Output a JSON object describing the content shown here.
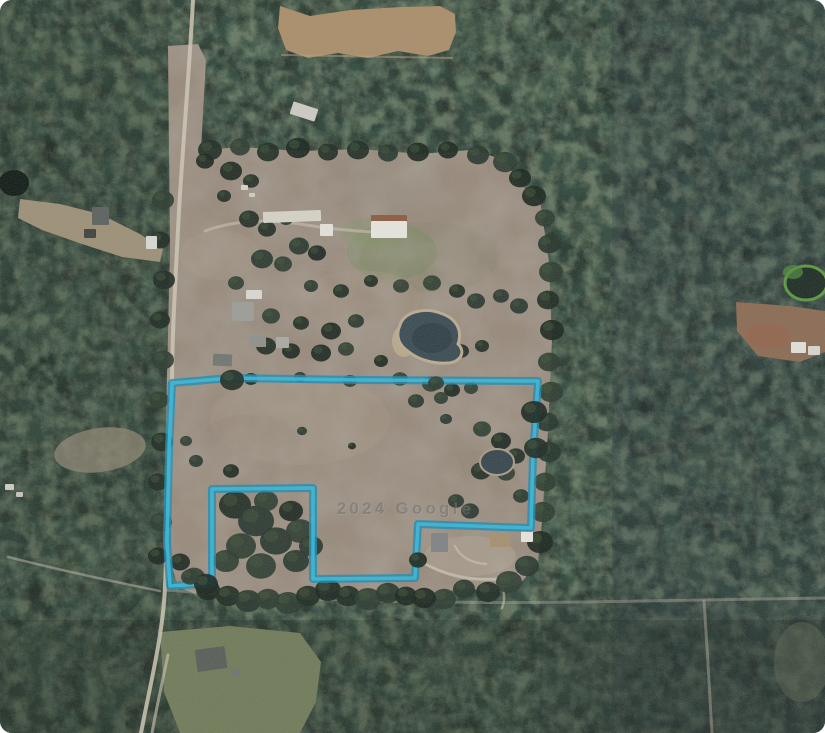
{
  "app": {
    "type": "satellite-imagery-view",
    "alt": "Aerial satellite photo of rural wooded land with pastures, ponds, farm buildings and a cyan property-boundary outline"
  },
  "watermark": {
    "text": "2024 Google"
  },
  "colors": {
    "forest_base": "#26322a",
    "forest_dark": "#16211a",
    "forest_light": "#3f5340",
    "pasture": "#97897b",
    "field": "#a98d69",
    "clearing_tan": "#9c8f76",
    "clearing_green": "#6f7a58",
    "clearing_red": "#8a6a52",
    "road": "#cfc7b4",
    "water_dark": "#2c3b42",
    "water_main": "#394a52",
    "pond_rim": "#bbaa8e",
    "boundary_outer": "#1e89ad",
    "boundary_inner": "#36b7d8",
    "watermark_front": "rgba(70,74,78,0.40)",
    "watermark_back": "rgba(255,255,255,0.16)"
  },
  "boundary": {
    "stroke_width_outer": 8,
    "stroke_width_inner": 3.5,
    "points": [
      [
        172,
        383
      ],
      [
        230,
        378
      ],
      [
        360,
        380
      ],
      [
        538,
        381
      ],
      [
        533,
        455
      ],
      [
        531,
        528
      ],
      [
        418,
        524
      ],
      [
        415,
        578
      ],
      [
        313,
        579
      ],
      [
        313,
        488
      ],
      [
        212,
        489
      ],
      [
        212,
        583
      ],
      [
        170,
        586
      ],
      [
        167,
        540
      ],
      [
        169,
        450
      ]
    ]
  },
  "scene": {
    "pasture_d": "M168,46 L198,44 L206,60 L201,150 L240,147 L300,151 L360,149 L420,154 L470,150 L506,160 L517,182 L540,200 L549,262 L552,340 L548,432 L542,522 L538,562 L520,584 L490,592 L460,587 L430,600 L400,592 L370,598 L340,590 L310,600 L280,594 L250,600 L220,590 L195,594 L178,587 L170,560 L166,420 L170,250 Z",
    "field_d": "M280,6 L310,16 L350,10 L400,7 L440,6 L455,14 L456,32 L449,50 L428,56 L398,51 L368,58 L338,53 L308,58 L286,50 L278,28 Z",
    "left_clearing_d": "M18,218 L42,230 L82,244 L122,257 L160,262 L163,249 L140,234 L100,214 L60,204 L20,199 Z",
    "green_bottom_d": "M160,632 L230,626 L300,633 L321,662 L316,702 L300,733 L180,733 L164,692 Z",
    "right_clearing_d": "M736,302 L790,306 L825,311 L825,352 L800,362 L758,356 L737,331 Z",
    "left_small_ellipse": [
      100,
      450,
      46,
      22,
      "#8f8573",
      0.75,
      -8
    ],
    "red_patch": [
      768,
      336,
      22,
      12,
      "#96604a",
      0.6
    ],
    "br_patch": [
      802,
      662,
      28,
      40,
      "#596350",
      0.5
    ],
    "tint_rects": [
      [
        612,
        0,
        213,
        733,
        "#2a3440",
        0.22
      ],
      [
        540,
        600,
        285,
        133,
        "#222b34",
        0.2
      ],
      [
        0,
        0,
        168,
        733,
        "#202b23",
        0.18
      ],
      [
        0,
        620,
        825,
        113,
        "#1b241d",
        0.25
      ]
    ],
    "pasture_tints": [
      [
        392,
        252,
        45,
        28,
        "#6f8a58",
        0.5
      ],
      [
        368,
        233,
        28,
        16,
        "#7b9160",
        0.45
      ],
      [
        430,
        257,
        70,
        35,
        "#7c8264",
        0.25
      ],
      [
        360,
        300,
        60,
        30,
        "#a1937f",
        0.35
      ],
      [
        300,
        420,
        90,
        45,
        "#a49684",
        0.4
      ],
      [
        470,
        480,
        50,
        30,
        "#8f8374",
        0.35
      ],
      [
        220,
        255,
        40,
        25,
        "#a59780",
        0.3
      ],
      [
        380,
        180,
        70,
        30,
        "#8f8776",
        0.3
      ],
      [
        480,
        205,
        40,
        22,
        "#999079",
        0.3
      ],
      [
        430,
        532,
        60,
        22,
        "#9c8e7e",
        0.35
      ],
      [
        250,
        442,
        50,
        28,
        "#8d8173",
        0.3
      ],
      [
        470,
        556,
        46,
        20,
        "#b3a894",
        0.45
      ],
      [
        200,
        520,
        25,
        40,
        "#9a8c7c",
        0.35
      ]
    ],
    "forest_blobs": [
      [
        50,
        60,
        35,
        1
      ],
      [
        140,
        100,
        28,
        1
      ],
      [
        60,
        330,
        30,
        1
      ],
      [
        30,
        430,
        26,
        1
      ],
      [
        90,
        560,
        30,
        1
      ],
      [
        40,
        650,
        35,
        1
      ],
      [
        120,
        690,
        28,
        1
      ],
      [
        580,
        60,
        30,
        1
      ],
      [
        640,
        140,
        34,
        1
      ],
      [
        700,
        60,
        30,
        1
      ],
      [
        780,
        40,
        32,
        1
      ],
      [
        600,
        220,
        28,
        1
      ],
      [
        660,
        320,
        30,
        1
      ],
      [
        720,
        460,
        34,
        1
      ],
      [
        640,
        480,
        28,
        1
      ],
      [
        580,
        520,
        26,
        1
      ],
      [
        700,
        560,
        30,
        1
      ],
      [
        770,
        600,
        28,
        1
      ],
      [
        620,
        640,
        30,
        1
      ],
      [
        700,
        690,
        32,
        1
      ],
      [
        560,
        680,
        28,
        1
      ],
      [
        360,
        650,
        30,
        1
      ],
      [
        430,
        680,
        28,
        1
      ],
      [
        500,
        700,
        30,
        1
      ],
      [
        250,
        40,
        26,
        1
      ],
      [
        350,
        30,
        24,
        1
      ],
      [
        480,
        30,
        26,
        1
      ],
      [
        540,
        90,
        24,
        1
      ],
      [
        560,
        160,
        26,
        1
      ],
      [
        760,
        200,
        30,
        1
      ],
      [
        800,
        440,
        30,
        1
      ],
      [
        560,
        400,
        26,
        1
      ],
      [
        590,
        470,
        24,
        1
      ],
      [
        30,
        150,
        30,
        0
      ],
      [
        100,
        250,
        28,
        0
      ],
      [
        50,
        380,
        30,
        0
      ],
      [
        20,
        600,
        32,
        0
      ],
      [
        150,
        620,
        26,
        0
      ],
      [
        610,
        90,
        30,
        0
      ],
      [
        690,
        180,
        34,
        0
      ],
      [
        730,
        240,
        26,
        0
      ],
      [
        660,
        400,
        30,
        0
      ],
      [
        730,
        520,
        32,
        0
      ],
      [
        600,
        600,
        30,
        0
      ],
      [
        660,
        660,
        32,
        0
      ],
      [
        520,
        640,
        28,
        0
      ],
      [
        400,
        630,
        26,
        0
      ],
      [
        300,
        650,
        28,
        0
      ],
      [
        230,
        710,
        26,
        0
      ],
      [
        460,
        710,
        28,
        0
      ],
      [
        570,
        30,
        26,
        0
      ],
      [
        640,
        30,
        24,
        0
      ],
      [
        810,
        120,
        30,
        0
      ],
      [
        790,
        500,
        30,
        0
      ],
      [
        560,
        250,
        24,
        0
      ],
      [
        545,
        330,
        22,
        0
      ],
      [
        545,
        450,
        22,
        0
      ]
    ],
    "tree_clumps": [
      [
        210,
        150,
        12
      ],
      [
        240,
        147,
        10
      ],
      [
        268,
        152,
        11
      ],
      [
        298,
        148,
        12
      ],
      [
        328,
        152,
        10
      ],
      [
        358,
        150,
        11
      ],
      [
        388,
        153,
        10
      ],
      [
        418,
        152,
        11
      ],
      [
        448,
        150,
        10
      ],
      [
        478,
        155,
        11
      ],
      [
        505,
        162,
        12
      ],
      [
        520,
        178,
        11
      ],
      [
        534,
        196,
        12
      ],
      [
        545,
        218,
        10
      ],
      [
        549,
        244,
        11
      ],
      [
        551,
        272,
        12
      ],
      [
        548,
        300,
        11
      ],
      [
        552,
        330,
        12
      ],
      [
        549,
        362,
        11
      ],
      [
        551,
        392,
        12
      ],
      [
        547,
        422,
        11
      ],
      [
        549,
        452,
        12
      ],
      [
        545,
        482,
        11
      ],
      [
        543,
        512,
        12
      ],
      [
        540,
        542,
        13
      ],
      [
        527,
        566,
        12
      ],
      [
        509,
        582,
        13
      ],
      [
        488,
        592,
        12
      ],
      [
        464,
        589,
        11
      ],
      [
        444,
        599,
        12
      ],
      [
        163,
        200,
        11
      ],
      [
        160,
        240,
        10
      ],
      [
        164,
        280,
        11
      ],
      [
        160,
        320,
        10
      ],
      [
        163,
        360,
        11
      ],
      [
        159,
        400,
        10
      ],
      [
        162,
        442,
        11
      ],
      [
        158,
        482,
        10
      ],
      [
        161,
        522,
        11
      ],
      [
        158,
        556,
        10
      ],
      [
        180,
        562,
        10
      ],
      [
        194,
        577,
        11
      ],
      [
        208,
        590,
        12
      ],
      [
        228,
        596,
        12
      ],
      [
        248,
        601,
        13
      ],
      [
        268,
        599,
        12
      ],
      [
        288,
        603,
        13
      ],
      [
        308,
        596,
        12
      ],
      [
        328,
        590,
        13
      ],
      [
        348,
        596,
        12
      ],
      [
        368,
        599,
        13
      ],
      [
        388,
        593,
        12
      ],
      [
        406,
        596,
        11
      ],
      [
        424,
        598,
        12
      ],
      [
        205,
        161,
        9
      ],
      [
        231,
        171,
        11
      ],
      [
        251,
        181,
        8
      ],
      [
        224,
        196,
        7
      ],
      [
        249,
        219,
        10
      ],
      [
        267,
        229,
        9
      ],
      [
        286,
        219,
        7
      ],
      [
        299,
        246,
        10
      ],
      [
        317,
        253,
        9
      ],
      [
        262,
        259,
        11
      ],
      [
        283,
        264,
        9
      ],
      [
        236,
        283,
        8
      ],
      [
        311,
        286,
        7
      ],
      [
        341,
        291,
        8
      ],
      [
        371,
        281,
        7
      ],
      [
        401,
        286,
        8
      ],
      [
        432,
        283,
        9
      ],
      [
        457,
        291,
        8
      ],
      [
        476,
        301,
        9
      ],
      [
        501,
        296,
        8
      ],
      [
        519,
        306,
        9
      ],
      [
        271,
        316,
        9
      ],
      [
        301,
        323,
        8
      ],
      [
        331,
        331,
        10
      ],
      [
        356,
        321,
        8
      ],
      [
        266,
        346,
        10
      ],
      [
        291,
        351,
        9
      ],
      [
        321,
        353,
        10
      ],
      [
        346,
        349,
        8
      ],
      [
        381,
        361,
        7
      ],
      [
        461,
        351,
        8
      ],
      [
        482,
        346,
        7
      ],
      [
        251,
        379,
        7
      ],
      [
        300,
        377,
        6
      ],
      [
        350,
        381,
        7
      ],
      [
        400,
        379,
        8
      ],
      [
        431,
        384,
        9
      ],
      [
        452,
        390,
        8
      ],
      [
        471,
        388,
        7
      ],
      [
        416,
        401,
        8
      ],
      [
        441,
        398,
        7
      ],
      [
        482,
        429,
        9
      ],
      [
        501,
        441,
        10
      ],
      [
        516,
        456,
        9
      ],
      [
        481,
        471,
        10
      ],
      [
        506,
        473,
        9
      ],
      [
        446,
        419,
        6
      ],
      [
        302,
        431,
        5
      ],
      [
        352,
        446,
        4
      ],
      [
        231,
        471,
        8
      ],
      [
        196,
        461,
        7
      ],
      [
        186,
        441,
        6
      ],
      [
        235,
        505,
        16
      ],
      [
        256,
        521,
        18
      ],
      [
        276,
        541,
        16
      ],
      [
        241,
        546,
        15
      ],
      [
        300,
        531,
        14
      ],
      [
        266,
        501,
        12
      ],
      [
        291,
        511,
        12
      ],
      [
        226,
        561,
        13
      ],
      [
        261,
        566,
        15
      ],
      [
        296,
        561,
        13
      ],
      [
        311,
        546,
        12
      ],
      [
        456,
        501,
        8
      ],
      [
        470,
        511,
        9
      ],
      [
        521,
        496,
        8
      ]
    ],
    "boundary_trees": [
      [
        232,
        380,
        12
      ],
      [
        436,
        383,
        8
      ],
      [
        534,
        412,
        13
      ],
      [
        536,
        448,
        12
      ],
      [
        206,
        584,
        12
      ],
      [
        190,
        577,
        9
      ],
      [
        418,
        560,
        9
      ]
    ],
    "roads": [
      {
        "d": "M193,0 C190,60 184,130 179,210 C175,290 172,335 172,385 C171,455 167,525 165,587 C163,635 150,685 141,733",
        "w": 4,
        "c": "#cfc7b4",
        "o": 0.85
      },
      {
        "d": "M166,590 C300,601 450,604 580,602 C680,601 760,599 825,598",
        "w": 3,
        "c": "#b7b0a0",
        "o": 0.4
      },
      {
        "d": "M704,601 C707,645 710,695 712,733",
        "w": 3,
        "c": "#b7b0a0",
        "o": 0.45
      },
      {
        "d": "M160,591 C115,582 60,570 8,557",
        "w": 2.5,
        "c": "#c4bcaa",
        "o": 0.5
      },
      {
        "d": "M420,561 C445,576 470,581 500,579 C518,577 528,570 531,561",
        "w": 3,
        "c": "#ccc4b2",
        "o": 0.75
      },
      {
        "d": "M455,546 C460,556 470,563 486,564",
        "w": 2.5,
        "c": "#ccc4b2",
        "o": 0.6
      },
      {
        "d": "M500,579 C505,591 505,601 502,608",
        "w": 2.5,
        "c": "#ccc4b2",
        "o": 0.55
      },
      {
        "d": "M168,655 C160,692 155,716 152,733",
        "w": 3,
        "c": "#c6beac",
        "o": 0.65
      },
      {
        "d": "M205,231 C230,222 262,218 300,224 C330,229 355,231 372,232",
        "w": 3,
        "c": "#c8c0ae",
        "o": 0.6
      },
      {
        "d": "M282,55 L452,58",
        "w": 2,
        "c": "#b8a27f",
        "o": 0.5
      }
    ],
    "main_pond_d": "M400,325 C404,312 424,307 440,313 C456,318 463,330 458,344 C467,353 459,363 447,363 C434,364 419,360 409,352 C397,344 396,334 400,325 Z",
    "buildings": [
      [
        263,
        211,
        58,
        11,
        "#d6d2c6",
        -2
      ],
      [
        320,
        224,
        13,
        12,
        "#e4e2da",
        0
      ],
      [
        371,
        215,
        36,
        7,
        "#8a5a3f",
        0
      ],
      [
        371,
        221,
        36,
        17,
        "#e7e5de",
        0
      ],
      [
        232,
        302,
        22,
        19,
        "#9b9b97",
        0
      ],
      [
        246,
        290,
        16,
        9,
        "#dad8d0",
        0
      ],
      [
        249,
        336,
        17,
        11,
        "#8e8f8b",
        0
      ],
      [
        276,
        337,
        13,
        11,
        "#a9a9a5",
        0
      ],
      [
        213,
        354,
        19,
        12,
        "#70756f",
        3
      ],
      [
        291,
        105,
        26,
        13,
        "#ccccc4",
        18
      ],
      [
        92,
        207,
        17,
        18,
        "#5b605d",
        0
      ],
      [
        146,
        236,
        11,
        13,
        "#d9d9d3",
        0
      ],
      [
        84,
        229,
        12,
        9,
        "#3c403d",
        0
      ],
      [
        431,
        533,
        17,
        19,
        "#7e8284",
        0
      ],
      [
        490,
        533,
        20,
        14,
        "#a78f6f",
        0
      ],
      [
        521,
        531,
        12,
        11,
        "#e7e5df",
        0
      ],
      [
        196,
        648,
        30,
        22,
        "#575c57",
        -8
      ],
      [
        231,
        669,
        9,
        8,
        "#6e736d",
        0
      ],
      [
        791,
        342,
        15,
        11,
        "#e2e0d8",
        0
      ],
      [
        808,
        346,
        12,
        9,
        "#d8d6ce",
        0
      ],
      [
        241,
        185,
        7,
        5,
        "#d8d5cb",
        0
      ],
      [
        249,
        193,
        6,
        4,
        "#cfccc2",
        0
      ],
      [
        5,
        484,
        9,
        6,
        "#cfccc4",
        0
      ],
      [
        16,
        492,
        7,
        5,
        "#c5c2ba",
        0
      ]
    ]
  }
}
